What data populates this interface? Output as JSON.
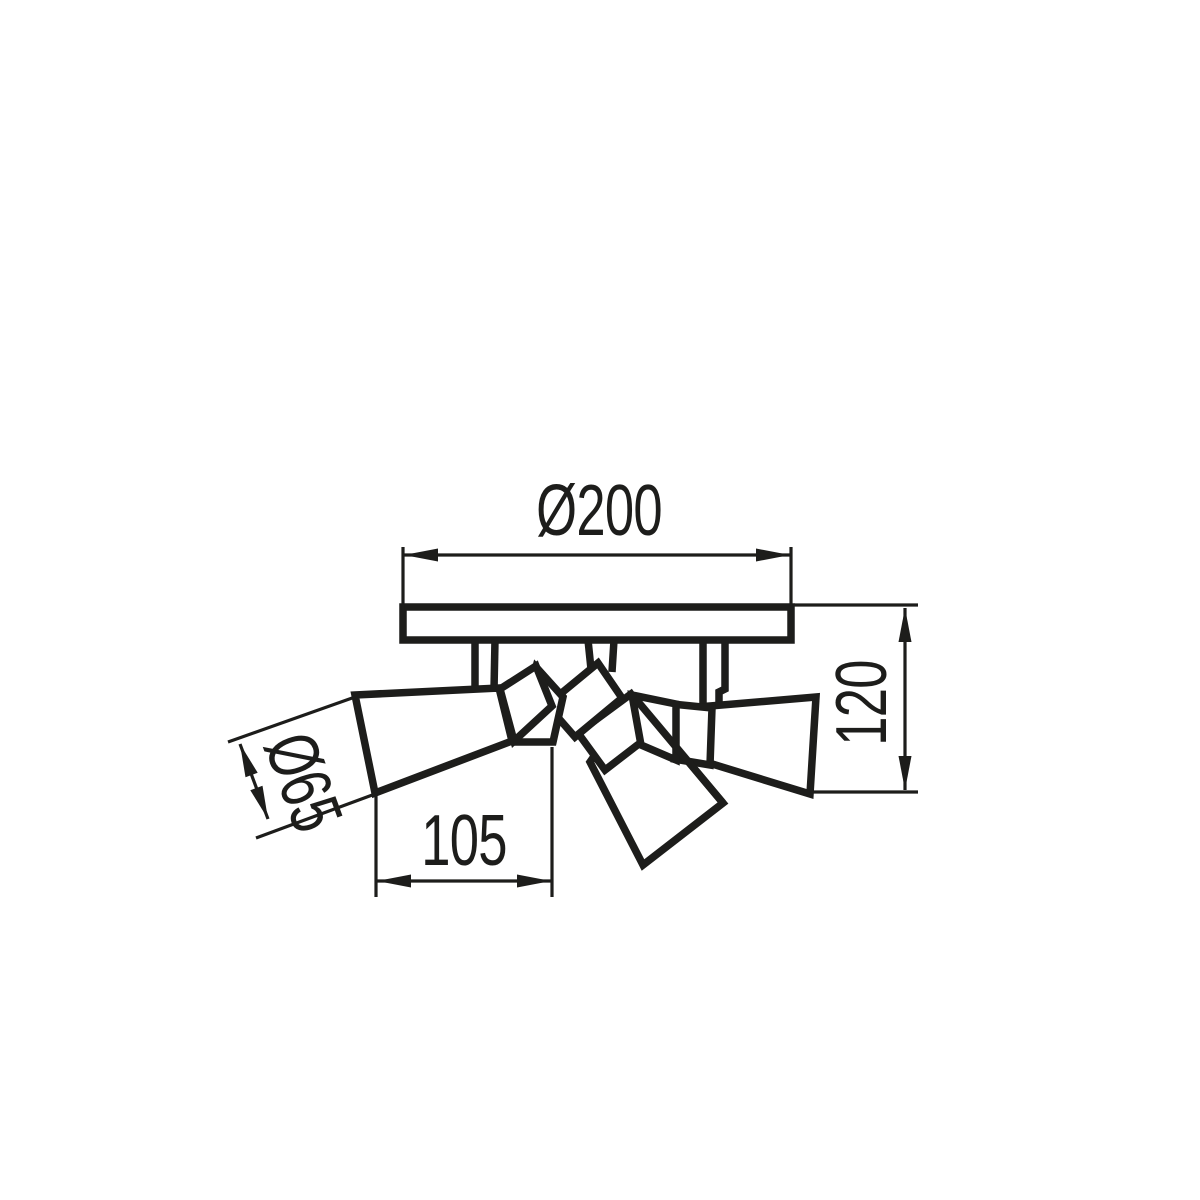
{
  "drawing": {
    "background_color": "#ffffff",
    "line_color": "#1d1d1b",
    "dimensions": {
      "plate_diameter": {
        "label": "Ø200",
        "value": 200
      },
      "overall_height": {
        "label": "120",
        "value": 120
      },
      "head_length": {
        "label": "105",
        "value": 105
      },
      "head_diameter": {
        "label": "Ø65",
        "value": 65
      }
    }
  }
}
